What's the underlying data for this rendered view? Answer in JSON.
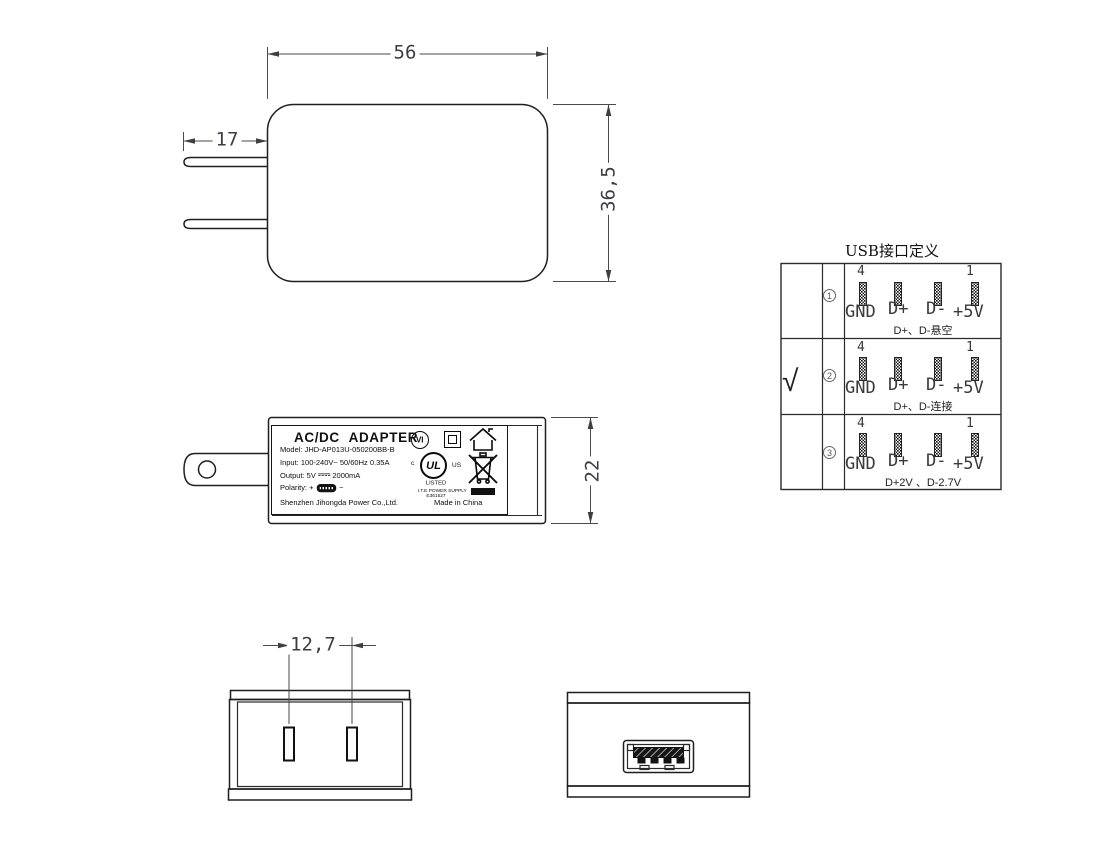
{
  "drawing": {
    "dimensions": {
      "body_width": "56",
      "blade_length": "17",
      "body_height": "36,5",
      "body_depth": "22",
      "blade_pitch": "12,7"
    },
    "label": {
      "title": "AC/DC ADAPTER",
      "model": "Model: JHD-AP013U-050200BB-B",
      "input": "Input: 100-240V~ 50/60Hz 0.35A",
      "output_prefix": "Output: 5V",
      "output_suffix": "2000mA",
      "polarity_label": "Polarity:",
      "plus": "+",
      "minus": "−",
      "company": "Shenzhen Jihongda Power Co.,Ltd.",
      "made_in": "Made in China"
    },
    "marks": {
      "efficiency": "VI",
      "ul_c": "c",
      "ul": "UL",
      "ul_us": "US",
      "listed": "LISTED",
      "ite": "I.T.E.POWER SUPPLY",
      "ul_file": "E361527"
    },
    "usb_table": {
      "title": "USB接口定义",
      "checkmark": "√",
      "pin_first": "4",
      "pin_last": "1",
      "pin_labels": [
        "GND",
        "D+",
        "D-",
        "+5V"
      ],
      "rows": [
        {
          "num": "1",
          "note": "D+、D-悬空"
        },
        {
          "num": "2",
          "note": "D+、D-连接"
        },
        {
          "num": "3",
          "note": "D+2V 、D-2.7V"
        }
      ]
    }
  }
}
